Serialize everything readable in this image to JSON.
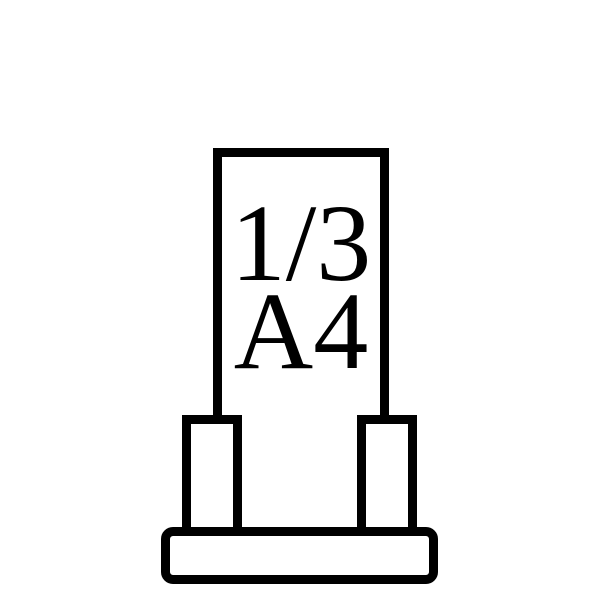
{
  "figure": {
    "description": "Line pictogram of a 1/3 A4 sign holder display stand",
    "panel": {
      "label_line1": "1/3",
      "label_line2": "A4"
    }
  },
  "colors": {
    "stroke": "#000000",
    "fill": "#ffffff"
  }
}
